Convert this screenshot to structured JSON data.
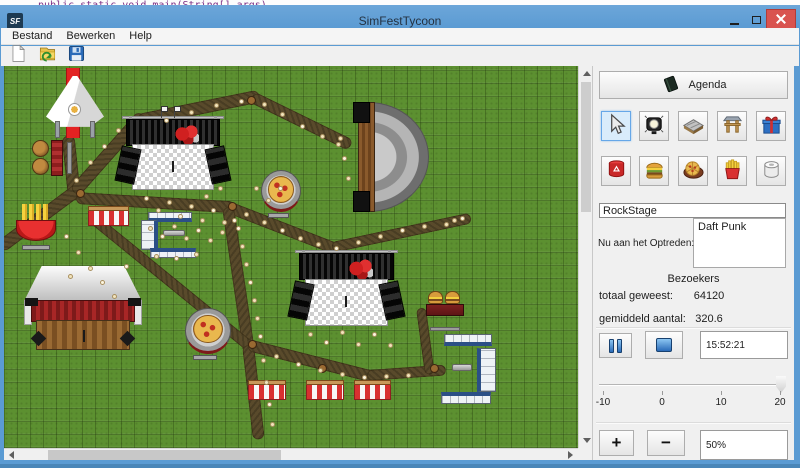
{
  "desktop": {
    "code_line": "public static void main(String[] args)"
  },
  "window": {
    "icon_text": "SF",
    "title": "SimFestTycoon",
    "controls": [
      {
        "name": "minimize-icon"
      },
      {
        "name": "maximize-icon"
      },
      {
        "name": "close-icon"
      }
    ],
    "menu": [
      {
        "label": "Bestand"
      },
      {
        "label": "Bewerken"
      },
      {
        "label": "Help"
      }
    ],
    "toolbar": [
      {
        "name": "new-file"
      },
      {
        "name": "open-file"
      },
      {
        "name": "save-file"
      }
    ]
  },
  "panel": {
    "agenda": {
      "label": "Agenda",
      "icon": "agenda-book-icon"
    },
    "tools": [
      {
        "name": "cursor-tool",
        "selected": true
      },
      {
        "name": "spotlight-tool",
        "selected": false
      },
      {
        "name": "stage-platform-tool",
        "selected": false
      },
      {
        "name": "entrance-gate-tool",
        "selected": false
      },
      {
        "name": "gift-shop-tool",
        "selected": false
      },
      {
        "name": "trash-can-tool",
        "selected": false
      },
      {
        "name": "burger-stand-tool",
        "selected": false
      },
      {
        "name": "pizza-stand-tool",
        "selected": false
      },
      {
        "name": "fries-stand-tool",
        "selected": false
      },
      {
        "name": "toilet-tool",
        "selected": false
      }
    ],
    "stage_name": {
      "value": "RockStage"
    },
    "now_performing": {
      "label": "Nu aan het Optreden:",
      "value": "Daft Punk"
    },
    "visitors": {
      "header": "Bezoekers",
      "total_label": "totaal geweest:",
      "total_value": "64120",
      "avg_label": "gemiddeld aantal:",
      "avg_value": "320.6"
    },
    "playback": {
      "pause_icon": "pause-icon",
      "stop_icon": "stop-icon",
      "time_value": "15:52:21"
    },
    "speed_slider": {
      "min": -10,
      "max": 20,
      "value": 20,
      "ticks": [
        "-10",
        "0",
        "10",
        "20"
      ]
    },
    "zoom_controls": {
      "plus_label": "+",
      "minus_label": "−",
      "level_value": "50%"
    }
  },
  "colors": {
    "titlebar_blue": "#5b9bd3",
    "close_red": "#d9534f",
    "grass_green": "#5c9030",
    "path_brown": "#594a2b",
    "carpet_red": "#e32222",
    "selection_blue": "#d9ecfb"
  },
  "map": {
    "paths": [
      [
        68,
        69,
        74,
        126,
        13
      ],
      [
        0,
        181,
        74,
        126,
        13
      ],
      [
        74,
        126,
        138,
        54,
        13
      ],
      [
        138,
        54,
        252,
        31,
        13
      ],
      [
        252,
        31,
        344,
        76,
        12
      ],
      [
        76,
        132,
        228,
        141,
        12
      ],
      [
        228,
        141,
        331,
        181,
        12
      ],
      [
        331,
        181,
        463,
        153,
        11
      ],
      [
        228,
        141,
        248,
        279,
        12
      ],
      [
        92,
        152,
        244,
        276,
        11
      ],
      [
        248,
        279,
        258,
        366,
        12
      ],
      [
        248,
        279,
        366,
        309,
        12
      ],
      [
        366,
        309,
        438,
        304,
        11
      ],
      [
        420,
        242,
        428,
        302,
        10
      ]
    ],
    "objects": [
      {
        "type": "carpet",
        "name": "entrance-carpet",
        "x": 62,
        "y": 2,
        "w": 14,
        "h": 70
      },
      {
        "type": "tent",
        "name": "entrance-tent",
        "x": 42,
        "y": 10,
        "w": 58,
        "h": 62
      },
      {
        "type": "stage",
        "name": "main-stage",
        "x": 114,
        "y": 50,
        "w": 110,
        "h": 78
      },
      {
        "type": "flag",
        "name": "stage-flag",
        "x": 153,
        "y": 40,
        "w": 9,
        "h": 12
      },
      {
        "type": "flag",
        "name": "stage-flag",
        "x": 166,
        "y": 40,
        "w": 9,
        "h": 12
      },
      {
        "type": "amphitheater",
        "name": "amphitheater-stage",
        "x": 349,
        "y": 36,
        "w": 76,
        "h": 110
      },
      {
        "type": "kegbar",
        "name": "beer-stand",
        "x": 28,
        "y": 74,
        "w": 42,
        "h": 36
      },
      {
        "type": "fries",
        "name": "fries-stand",
        "x": 12,
        "y": 138,
        "w": 40,
        "h": 46
      },
      {
        "type": "stall",
        "name": "striped-stall",
        "x": 84,
        "y": 140,
        "w": 41,
        "h": 20
      },
      {
        "type": "toilets",
        "name": "toilet-block",
        "x": 137,
        "y": 146,
        "w": 57,
        "h": 48,
        "parts": [
          {
            "x": 7,
            "y": 0,
            "w": 44,
            "h": 10,
            "side": "bottom"
          },
          {
            "x": 0,
            "y": 8,
            "w": 17,
            "h": 30,
            "side": "right"
          },
          {
            "x": 9,
            "y": 36,
            "w": 46,
            "h": 10,
            "side": "top"
          },
          {
            "x": 22,
            "y": 18,
            "w": 22,
            "h": 6,
            "side": "pipe"
          }
        ]
      },
      {
        "type": "barn",
        "name": "barn-stage",
        "x": 20,
        "y": 200,
        "w": 118,
        "h": 84
      },
      {
        "type": "pizza",
        "name": "pizza-stand",
        "x": 181,
        "y": 242,
        "w": 46,
        "h": 52
      },
      {
        "type": "pizza",
        "name": "pizza-stand",
        "x": 257,
        "y": 104,
        "w": 40,
        "h": 48
      },
      {
        "type": "stage",
        "name": "punk-stage",
        "x": 287,
        "y": 184,
        "w": 111,
        "h": 80
      },
      {
        "type": "burger",
        "name": "burger-stand",
        "x": 422,
        "y": 225,
        "w": 38,
        "h": 40
      },
      {
        "type": "toilets",
        "name": "toilet-block",
        "x": 437,
        "y": 268,
        "w": 56,
        "h": 70,
        "parts": [
          {
            "x": 3,
            "y": 0,
            "w": 48,
            "h": 12,
            "side": "bottom"
          },
          {
            "x": 36,
            "y": 14,
            "w": 19,
            "h": 44,
            "side": "left"
          },
          {
            "x": 0,
            "y": 58,
            "w": 50,
            "h": 12,
            "side": "top"
          },
          {
            "x": 11,
            "y": 30,
            "w": 20,
            "h": 7,
            "side": "pipe"
          }
        ]
      },
      {
        "type": "stall",
        "name": "striped-stall",
        "x": 244,
        "y": 314,
        "w": 38,
        "h": 20
      },
      {
        "type": "stall",
        "name": "striped-stall",
        "x": 302,
        "y": 314,
        "w": 38,
        "h": 20
      },
      {
        "type": "stall",
        "name": "striped-stall",
        "x": 350,
        "y": 314,
        "w": 37,
        "h": 20
      },
      {
        "type": "bin",
        "name": "waste-bin",
        "x": 243,
        "y": 30,
        "w": 9,
        "h": 9
      },
      {
        "type": "bin",
        "name": "waste-bin",
        "x": 72,
        "y": 123,
        "w": 9,
        "h": 9
      },
      {
        "type": "bin",
        "name": "waste-bin",
        "x": 224,
        "y": 136,
        "w": 9,
        "h": 9
      },
      {
        "type": "bin",
        "name": "waste-bin",
        "x": 244,
        "y": 274,
        "w": 9,
        "h": 9
      },
      {
        "type": "bin",
        "name": "waste-bin",
        "x": 314,
        "y": 298,
        "w": 9,
        "h": 9
      },
      {
        "type": "bin",
        "name": "waste-bin",
        "x": 426,
        "y": 298,
        "w": 9,
        "h": 9
      }
    ],
    "visitors": [
      [
        160,
        52
      ],
      [
        185,
        44
      ],
      [
        210,
        37
      ],
      [
        235,
        33
      ],
      [
        258,
        36
      ],
      [
        276,
        46
      ],
      [
        296,
        58
      ],
      [
        316,
        68
      ],
      [
        332,
        76
      ],
      [
        140,
        130
      ],
      [
        152,
        142
      ],
      [
        163,
        134
      ],
      [
        174,
        148
      ],
      [
        185,
        138
      ],
      [
        196,
        152
      ],
      [
        207,
        142
      ],
      [
        218,
        154
      ],
      [
        144,
        160
      ],
      [
        156,
        168
      ],
      [
        168,
        158
      ],
      [
        180,
        170
      ],
      [
        192,
        162
      ],
      [
        204,
        172
      ],
      [
        216,
        164
      ],
      [
        228,
        152
      ],
      [
        240,
        146
      ],
      [
        258,
        154
      ],
      [
        276,
        162
      ],
      [
        294,
        170
      ],
      [
        312,
        176
      ],
      [
        330,
        180
      ],
      [
        352,
        174
      ],
      [
        374,
        168
      ],
      [
        396,
        162
      ],
      [
        418,
        158
      ],
      [
        440,
        156
      ],
      [
        232,
        160
      ],
      [
        236,
        178
      ],
      [
        240,
        196
      ],
      [
        244,
        214
      ],
      [
        248,
        232
      ],
      [
        251,
        250
      ],
      [
        254,
        268
      ],
      [
        257,
        292
      ],
      [
        260,
        314
      ],
      [
        263,
        336
      ],
      [
        266,
        356
      ],
      [
        304,
        266
      ],
      [
        320,
        274
      ],
      [
        336,
        264
      ],
      [
        352,
        276
      ],
      [
        368,
        266
      ],
      [
        384,
        277
      ],
      [
        270,
        288
      ],
      [
        292,
        296
      ],
      [
        314,
        302
      ],
      [
        336,
        306
      ],
      [
        358,
        309
      ],
      [
        380,
        308
      ],
      [
        402,
        307
      ],
      [
        60,
        168
      ],
      [
        72,
        184
      ],
      [
        84,
        200
      ],
      [
        96,
        214
      ],
      [
        108,
        228
      ],
      [
        64,
        208
      ],
      [
        120,
        198
      ],
      [
        70,
        112
      ],
      [
        84,
        94
      ],
      [
        98,
        78
      ],
      [
        112,
        62
      ],
      [
        334,
        70
      ],
      [
        338,
        90
      ],
      [
        342,
        110
      ],
      [
        150,
        188
      ],
      [
        170,
        190
      ],
      [
        190,
        186
      ],
      [
        448,
        152
      ],
      [
        456,
        150
      ],
      [
        250,
        120
      ],
      [
        262,
        132
      ],
      [
        274,
        120
      ],
      [
        200,
        128
      ],
      [
        214,
        120
      ]
    ]
  }
}
